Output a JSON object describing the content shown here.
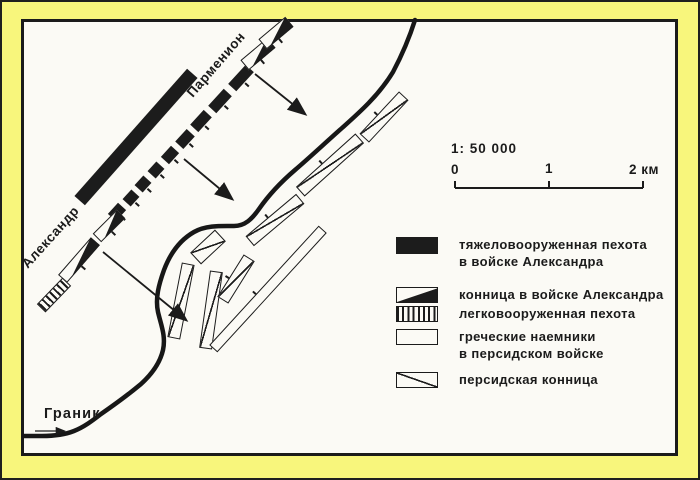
{
  "colors": {
    "background": "#f8f67c",
    "paper": "#fbfaf5",
    "ink": "#1b1b1b"
  },
  "map": {
    "labels": {
      "parmenion": "Парменион",
      "alexander": "Александр",
      "river": "Граник"
    },
    "scale": {
      "ratio": "1: 50 000",
      "tick0": "0",
      "tick1": "1",
      "tick2": "2 км"
    },
    "river_path": "M 413 18 C 407 37 400 53 391 70 C 377 93 358 110 340 126 C 322 142 306 157 293 168 C 279 180 266 194 257 207 C 250 217 243 224 232 224 C 220 224 204 223 192 230 C 178 238 168 252 162 268 C 157 282 153 296 156 310 C 159 323 164 334 161 348 C 158 361 150 372 139 382 C 127 392 112 403 99 412 C 90 419 82 425 72 429 C 62 433 50 434 40 434 L 22 434",
    "arrows": [
      {
        "name": "attack-arrow-parmenion",
        "x1": 253,
        "y1": 72,
        "x2": 303,
        "y2": 112,
        "kind": "attack"
      },
      {
        "name": "attack-arrow-phalanx",
        "x1": 182,
        "y1": 157,
        "x2": 230,
        "y2": 197,
        "kind": "attack"
      },
      {
        "name": "attack-arrow-alexander",
        "x1": 101,
        "y1": 250,
        "x2": 184,
        "y2": 318,
        "kind": "attack"
      },
      {
        "name": "river-flow-arrow",
        "x1": 33,
        "y1": 429,
        "x2": 62,
        "y2": 429,
        "kind": "flow"
      }
    ],
    "units": [
      {
        "cls": "solid",
        "name": "heavy-infantry-bar",
        "cx": 134,
        "cy": 135,
        "l": 170,
        "w": 14,
        "a": -48.5
      },
      {
        "cls": "solid",
        "name": "phalanx-segment",
        "cx": 115,
        "cy": 210,
        "l": 15,
        "w": 11,
        "a": -47.5,
        "tick": "b"
      },
      {
        "cls": "solid",
        "name": "phalanx-segment",
        "cx": 129,
        "cy": 196,
        "l": 13,
        "w": 11,
        "a": -47.5,
        "tick": "b"
      },
      {
        "cls": "solid",
        "name": "phalanx-segment",
        "cx": 141,
        "cy": 182,
        "l": 13,
        "w": 11,
        "a": -47.5,
        "tick": "b"
      },
      {
        "cls": "solid",
        "name": "phalanx-segment",
        "cx": 154,
        "cy": 168,
        "l": 13,
        "w": 11,
        "a": -47.5,
        "tick": "b"
      },
      {
        "cls": "solid",
        "name": "phalanx-segment",
        "cx": 168,
        "cy": 153,
        "l": 15,
        "w": 11,
        "a": -47.5,
        "tick": "b"
      },
      {
        "cls": "solid",
        "name": "phalanx-segment",
        "cx": 183,
        "cy": 137,
        "l": 17,
        "w": 11,
        "a": -47.5,
        "tick": "b"
      },
      {
        "cls": "solid",
        "name": "phalanx-segment",
        "cx": 199,
        "cy": 119,
        "l": 20,
        "w": 11,
        "a": -47.5,
        "tick": "b"
      },
      {
        "cls": "solid",
        "name": "phalanx-segment",
        "cx": 218,
        "cy": 99,
        "l": 23,
        "w": 11,
        "a": -47.5,
        "tick": "b"
      },
      {
        "cls": "solid",
        "name": "phalanx-segment",
        "cx": 239,
        "cy": 76,
        "l": 26,
        "w": 11,
        "a": -47.5,
        "tick": "b"
      },
      {
        "cls": "cav",
        "name": "macedonian-cavalry-unit",
        "cx": 77,
        "cy": 258,
        "l": 50,
        "w": 12,
        "a": -49,
        "tick": "b"
      },
      {
        "cls": "cav",
        "name": "macedonian-cavalry-unit",
        "cx": 107,
        "cy": 224,
        "l": 34,
        "w": 12,
        "a": -45,
        "tick": "b"
      },
      {
        "cls": "cav",
        "name": "macedonian-cavalry-unit",
        "cx": 256,
        "cy": 52,
        "l": 35,
        "w": 13,
        "a": -40,
        "tick": "b"
      },
      {
        "cls": "cav",
        "name": "macedonian-cavalry-unit",
        "cx": 274,
        "cy": 31,
        "l": 35,
        "w": 13,
        "a": -40,
        "tick": "b"
      },
      {
        "cls": "light",
        "name": "light-infantry-unit",
        "cx": 52,
        "cy": 293,
        "l": 37,
        "w": 12,
        "a": -46
      },
      {
        "cls": "per",
        "name": "persian-cavalry-unit",
        "cx": 382,
        "cy": 115,
        "l": 58,
        "w": 13,
        "a": -47,
        "tick": "t"
      },
      {
        "cls": "per",
        "name": "persian-cavalry-unit",
        "cx": 328,
        "cy": 163,
        "l": 80,
        "w": 13,
        "a": -42,
        "tick": "t"
      },
      {
        "cls": "per",
        "name": "persian-cavalry-unit",
        "cx": 273,
        "cy": 218,
        "l": 66,
        "w": 13,
        "a": -40,
        "tick": "t"
      },
      {
        "cls": "per",
        "name": "persian-cavalry-unit",
        "cx": 206,
        "cy": 245,
        "l": 34,
        "w": 16,
        "a": -43
      },
      {
        "cls": "per",
        "name": "persian-cavalry-unit",
        "cx": 179,
        "cy": 299,
        "l": 76,
        "w": 13,
        "a": -79
      },
      {
        "cls": "per",
        "name": "persian-cavalry-unit",
        "cx": 209,
        "cy": 308,
        "l": 78,
        "w": 13,
        "a": -82
      },
      {
        "cls": "per",
        "name": "persian-cavalry-unit",
        "cx": 234,
        "cy": 277,
        "l": 50,
        "w": 13,
        "a": -58,
        "tick": "t"
      },
      {
        "cls": "plain",
        "name": "greek-mercenary-unit",
        "cx": 266,
        "cy": 287,
        "l": 162,
        "w": 11,
        "a": -47.5,
        "tick": "t"
      }
    ]
  },
  "legend": {
    "items": [
      {
        "symbol": "heavy-infantry",
        "lines": [
          "тяжеловооруженная пехота",
          "в войске Александра"
        ]
      },
      {
        "symbol": "macedonian-cavalry",
        "lines": [
          "конница в войске Александра"
        ]
      },
      {
        "symbol": "light-infantry",
        "lines": [
          "легковооруженная пехота"
        ]
      },
      {
        "symbol": "greek-mercenaries",
        "lines": [
          "греческие наемники",
          "в персидском войске"
        ]
      },
      {
        "symbol": "persian-cavalry",
        "lines": [
          "персидская конница"
        ]
      }
    ]
  }
}
